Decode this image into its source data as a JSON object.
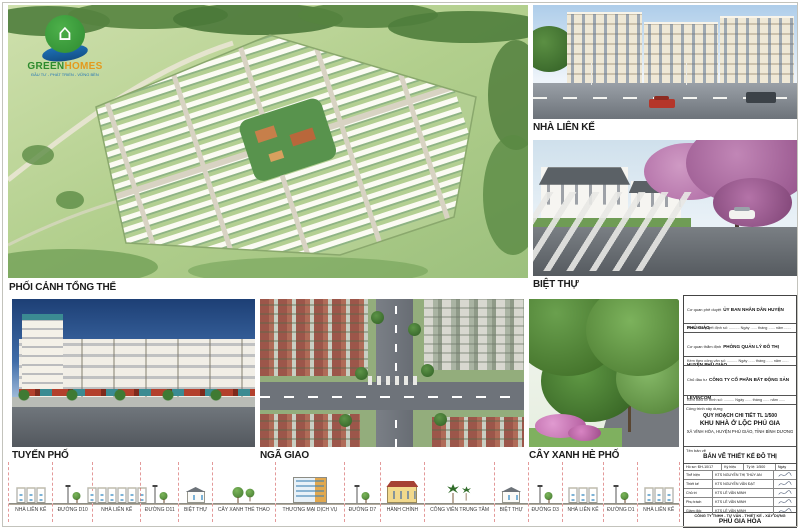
{
  "logo": {
    "green": "GREEN",
    "orange": "HOMES",
    "tagline": "ĐẦU TƯ - PHÁT TRIỂN - VỮNG BỀN"
  },
  "panels": {
    "overall": {
      "label": "PHỐI CẢNH TỔNG THỂ"
    },
    "townhouse": {
      "label": "NHÀ LIÊN KẾ"
    },
    "villa": {
      "label": "BIỆT THỰ"
    },
    "street": {
      "label": "TUYẾN PHỐ"
    },
    "intersection": {
      "label": "NGÃ GIAO"
    },
    "greenery": {
      "label": "CÂY XANH HÈ PHỐ"
    }
  },
  "title_block": {
    "approval_label": "Cơ quan phê duyệt",
    "approval_value": "ỦY BAN NHÂN DÂN HUYỆN PHÚ GIÁO",
    "decision_line": "Kèm theo quyết định số: .......... Ngày ...... tháng ...... năm ......",
    "appraisal_label": "Cơ quan thẩm định",
    "appraisal_value": "PHÒNG QUẢN LÝ ĐÔ THỊ HUYỆN PHÚ GIÁO",
    "document_line": "Kèm theo công văn số: .......... Ngày ...... tháng ...... năm ......",
    "investor_label": "Chủ đầu tư",
    "investor_value": "CÔNG TY CỔ PHẦN BẤT ĐỘNG SẢN LEVINCOM",
    "submission_line": "Kèm theo tờ trình số: .......... Ngày ...... tháng ...... năm ......",
    "project_label": "Công trình xây dựng",
    "project_line1": "QUY HOẠCH CHI TIẾT TL 1/500",
    "project_line2": "KHU NHÀ Ở LỘC PHÚ GIA",
    "project_line3": "XÃ VĨNH HÒA, HUYỆN PHÚ GIÁO, TỈNH BÌNH DƯƠNG",
    "drawing_label": "Tên bản vẽ",
    "drawing_value": "BẢN VẼ THIẾT KẾ ĐÔ THỊ",
    "sign_table": {
      "header": [
        "Hồ sơ: ĐH-10/17",
        "Ký hiệu",
        "Tỷ lệ: 1/500",
        "Ngày"
      ],
      "rows": [
        {
          "role": "Thể hiện",
          "name": "KTS NGUYỄN THỊ THÚY AN"
        },
        {
          "role": "Thiết kế",
          "name": "KTS NGUYỄN VĂN ĐẠT"
        },
        {
          "role": "Chủ trì",
          "name": "KTS LÊ VĂN MINH"
        },
        {
          "role": "Phụ trách",
          "name": "KTS LÊ VĂN MINH"
        },
        {
          "role": "Giám đốc",
          "name": "KTS LÊ VĂN MINH"
        }
      ]
    },
    "company_line1": "CÔNG TY TNHH - TƯ VẤN - THIẾT KẾ - XÂY DỰNG",
    "company_line2": "PHÚ GIA HÒA"
  },
  "elevation": {
    "segments": [
      {
        "label": "NHÀ LIÊN KẾ",
        "type": "rowhouse",
        "count": 3,
        "grow": 9
      },
      {
        "label": "ĐƯỜNG D10",
        "type": "road",
        "grow": 6
      },
      {
        "label": "NHÀ LIÊN KẾ",
        "type": "rowhouse",
        "count": 6,
        "grow": 12
      },
      {
        "label": "ĐƯỜNG D11",
        "type": "road",
        "grow": 5
      },
      {
        "label": "BIỆT THỰ",
        "type": "villa",
        "grow": 7
      },
      {
        "label": "CÂY XANH THỂ THAO",
        "type": "trees",
        "grow": 7
      },
      {
        "label": "THƯƠNG MẠI DỊCH VỤ",
        "type": "commercial",
        "grow": 10
      },
      {
        "label": "ĐƯỜNG D7",
        "type": "road",
        "grow": 5
      },
      {
        "label": "HÀNH CHÍNH",
        "type": "admin",
        "grow": 9
      },
      {
        "label": "CÔNG VIÊN TRUNG TÂM",
        "type": "palms",
        "grow": 7
      },
      {
        "label": "BIỆT THỰ",
        "type": "villa",
        "grow": 7
      },
      {
        "label": "ĐƯỜNG D3",
        "type": "road",
        "grow": 4
      },
      {
        "label": "NHÀ LIÊN KẾ",
        "type": "rowhouse",
        "count": 3,
        "grow": 7
      },
      {
        "label": "ĐƯỜNG D1",
        "type": "road",
        "grow": 4
      },
      {
        "label": "NHÀ LIÊN KẾ",
        "type": "rowhouse",
        "count": 3,
        "grow": 7
      }
    ]
  }
}
